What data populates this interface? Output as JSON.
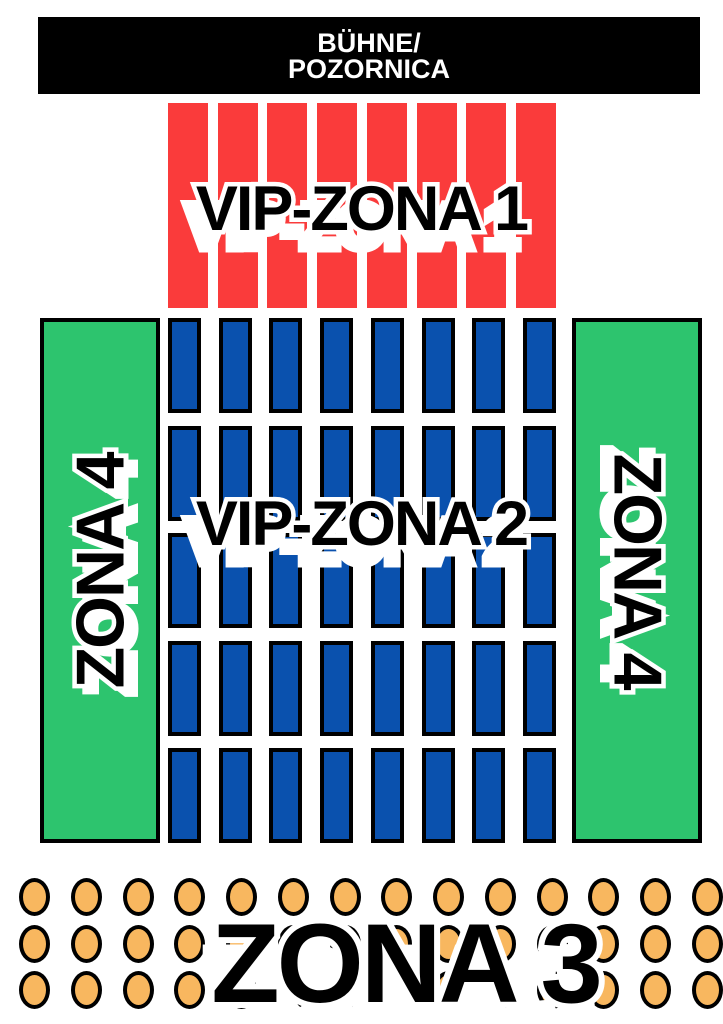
{
  "colors": {
    "red": "#fa3b3b",
    "blue": "#0a51ae",
    "green": "#2dc46e",
    "orange": "#f8b75f",
    "black": "#000000",
    "white": "#ffffff"
  },
  "stage": {
    "line1": "BÜHNE/",
    "line2": "POZORNICA"
  },
  "zones": {
    "vip1": {
      "label": "VIP-ZONA 1",
      "bar_count": 8
    },
    "vip2": {
      "label": "VIP-ZONA 2",
      "seat_count": 40,
      "columns": 8,
      "rows": 5
    },
    "zona4_left": {
      "label": "ZONA 4"
    },
    "zona4_right": {
      "label": "ZONA 4"
    },
    "zona3": {
      "label": "ZONA 3",
      "seat_count": 42,
      "columns": 14,
      "rows": 3
    }
  }
}
